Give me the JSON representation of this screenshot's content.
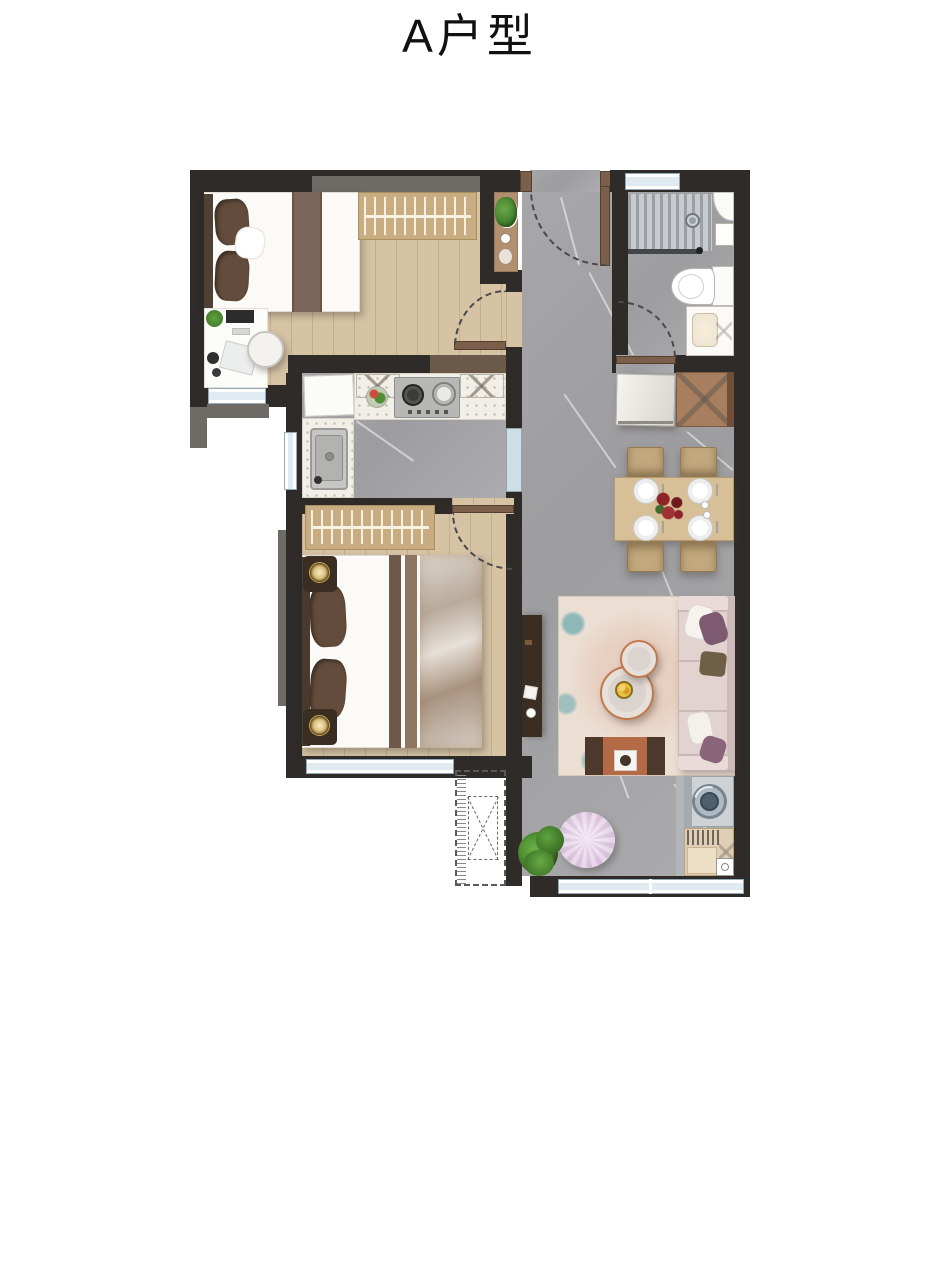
{
  "title": {
    "label": "A户型"
  },
  "palette": {
    "wall": "#2e2b28",
    "wallgray": "#6e6b66",
    "wood": "#d6c3a4",
    "tan": "#c9ad82",
    "tablewood": "#d7c097",
    "chairwood": "#c2a87c",
    "cabwood": "#a87f5e",
    "darkwood": "#3a2d22",
    "doorbrown": "#7b5f4b",
    "bedwhite": "#fbfaf7",
    "runner": "#7c665a",
    "pillow": "#634c3c",
    "sofapink": "#e2d3d1",
    "sofaback": "#cdbbb9",
    "cushpurple": "#7d5a70",
    "cusholive": "#6f5f46",
    "rug": "#ebdfd3",
    "rugteal": "#85b6bb",
    "pouf": "#dcc7de",
    "plant": "#4e8f35",
    "stove": "#b7b7b5",
    "washer": "#ced2d5",
    "drum": "#4e5f6d",
    "winframe": "#93a9b6",
    "orange": "#b56a47",
    "flower": "#8e2328",
    "glow": "#e9d195",
    "arc": "#4a4a4a",
    "text": "#111111"
  }
}
